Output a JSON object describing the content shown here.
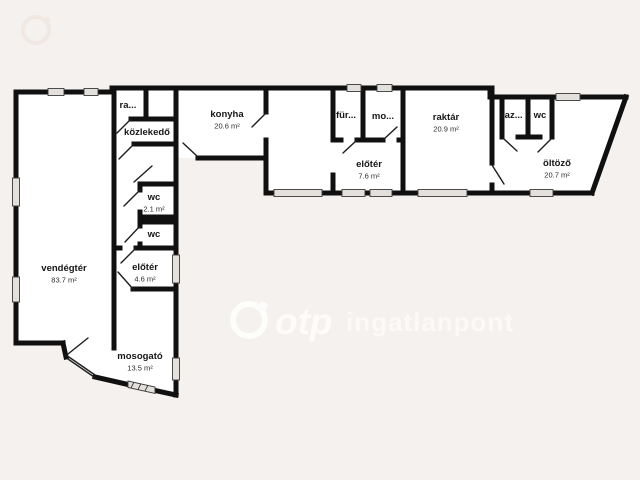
{
  "page": {
    "background_color": "#f4f1ee",
    "wall_color": "#101010",
    "room_fill": "#ffffff"
  },
  "watermark": {
    "logo_text": "otp",
    "brand_text": "ingatlanpont"
  },
  "rooms": [
    {
      "id": "ra",
      "label": "ra...",
      "area": "",
      "x": 128,
      "y": 108
    },
    {
      "id": "kozlekedo",
      "label": "közlekedő",
      "area": "",
      "x": 147,
      "y": 135
    },
    {
      "id": "konyha",
      "label": "konyha",
      "area": "20.6 m²",
      "x": 227,
      "y": 117
    },
    {
      "id": "fur",
      "label": "für...",
      "area": "",
      "x": 346,
      "y": 118
    },
    {
      "id": "mo",
      "label": "mo...",
      "area": "",
      "x": 383,
      "y": 119
    },
    {
      "id": "eloter-1",
      "label": "előtér",
      "area": "7.6 m²",
      "x": 369,
      "y": 167
    },
    {
      "id": "raktar",
      "label": "raktár",
      "area": "20.9 m²",
      "x": 446,
      "y": 120
    },
    {
      "id": "kaz",
      "label": "kaz...",
      "area": "",
      "x": 511,
      "y": 118
    },
    {
      "id": "wc-right",
      "label": "wc",
      "area": "",
      "x": 540,
      "y": 118
    },
    {
      "id": "oltozo",
      "label": "öltöző",
      "area": "20.7 m²",
      "x": 557,
      "y": 166
    },
    {
      "id": "vendegter",
      "label": "vendégtér",
      "area": "83.7 m²",
      "x": 64,
      "y": 271
    },
    {
      "id": "wc-1",
      "label": "wc",
      "area": "2.1 m²",
      "x": 154,
      "y": 200
    },
    {
      "id": "wc-2",
      "label": "wc",
      "area": "",
      "x": 154,
      "y": 237
    },
    {
      "id": "eloter-2",
      "label": "előtér",
      "area": "4.6 m²",
      "x": 145,
      "y": 270
    },
    {
      "id": "mosogato",
      "label": "mosogató",
      "area": "13.5 m²",
      "x": 140,
      "y": 359
    }
  ]
}
